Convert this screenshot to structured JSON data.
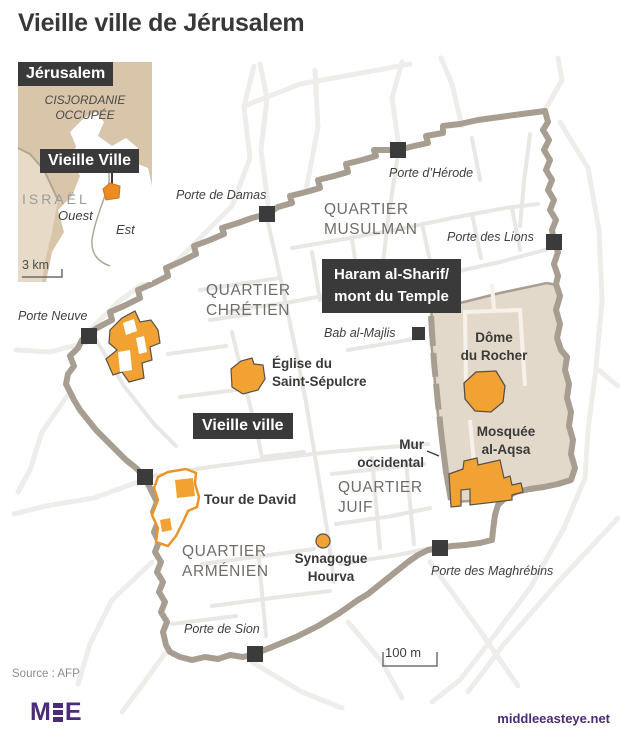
{
  "title": "Vieille ville de Jérusalem",
  "colors": {
    "accent_orange": "#F2A233",
    "wall_gray": "#A79D91",
    "haram_fill": "#E3D9CA",
    "label_box_bg": "#3A3A3A",
    "inset_beige": "#D8C5AA",
    "inset_beige_light": "#E7DBC7",
    "street_inner": "#E9E7E3",
    "street_outer": "#EFEDEA",
    "gate_square": "#3B3B3B",
    "brand_purple": "#4A2C78"
  },
  "inset": {
    "city_label": "Jérusalem",
    "region_label": "CISJORDANIE\nOCCUPÉE",
    "old_city_label": "Vieille Ville",
    "country_label": "ISRAËL",
    "west_label": "Ouest",
    "east_label": "Est",
    "scale_label": "3 km"
  },
  "map": {
    "labels": {
      "porte_neuve": "Porte Neuve",
      "porte_de_damas": "Porte de Damas",
      "porte_dherode": "Porte d’Hérode",
      "quartier_musulman": "QUARTIER\nMUSULMAN",
      "porte_des_lions": "Porte des Lions",
      "haram": "Haram al-Sharif/\nmont du Temple",
      "quartier_chretien": "QUARTIER\nCHRÉTIEN",
      "bab_al_majlis": "Bab al-Majlis",
      "eglise": "Église du\nSaint-Sépulcre",
      "dome": "Dôme\ndu Rocher",
      "vieille_ville": "Vieille ville",
      "mur_occidental": "Mur\noccidental",
      "mosquee": "Mosquée\nal-Aqsa",
      "quartier_juif": "QUARTIER\nJUIF",
      "tour_de_david": "Tour de David",
      "quartier_armenien": "QUARTIER\nARMÉNIEN",
      "synagogue": "Synagogue\nHourva",
      "porte_des_maghrebins": "Porte des Maghrébins",
      "porte_de_sion": "Porte de Sion",
      "scale": "100 m"
    }
  },
  "footer": {
    "source": "Source : AFP",
    "logo_text": "MEE",
    "logo_m": "M",
    "logo_e": "E",
    "website": "middleeasteye.net"
  }
}
